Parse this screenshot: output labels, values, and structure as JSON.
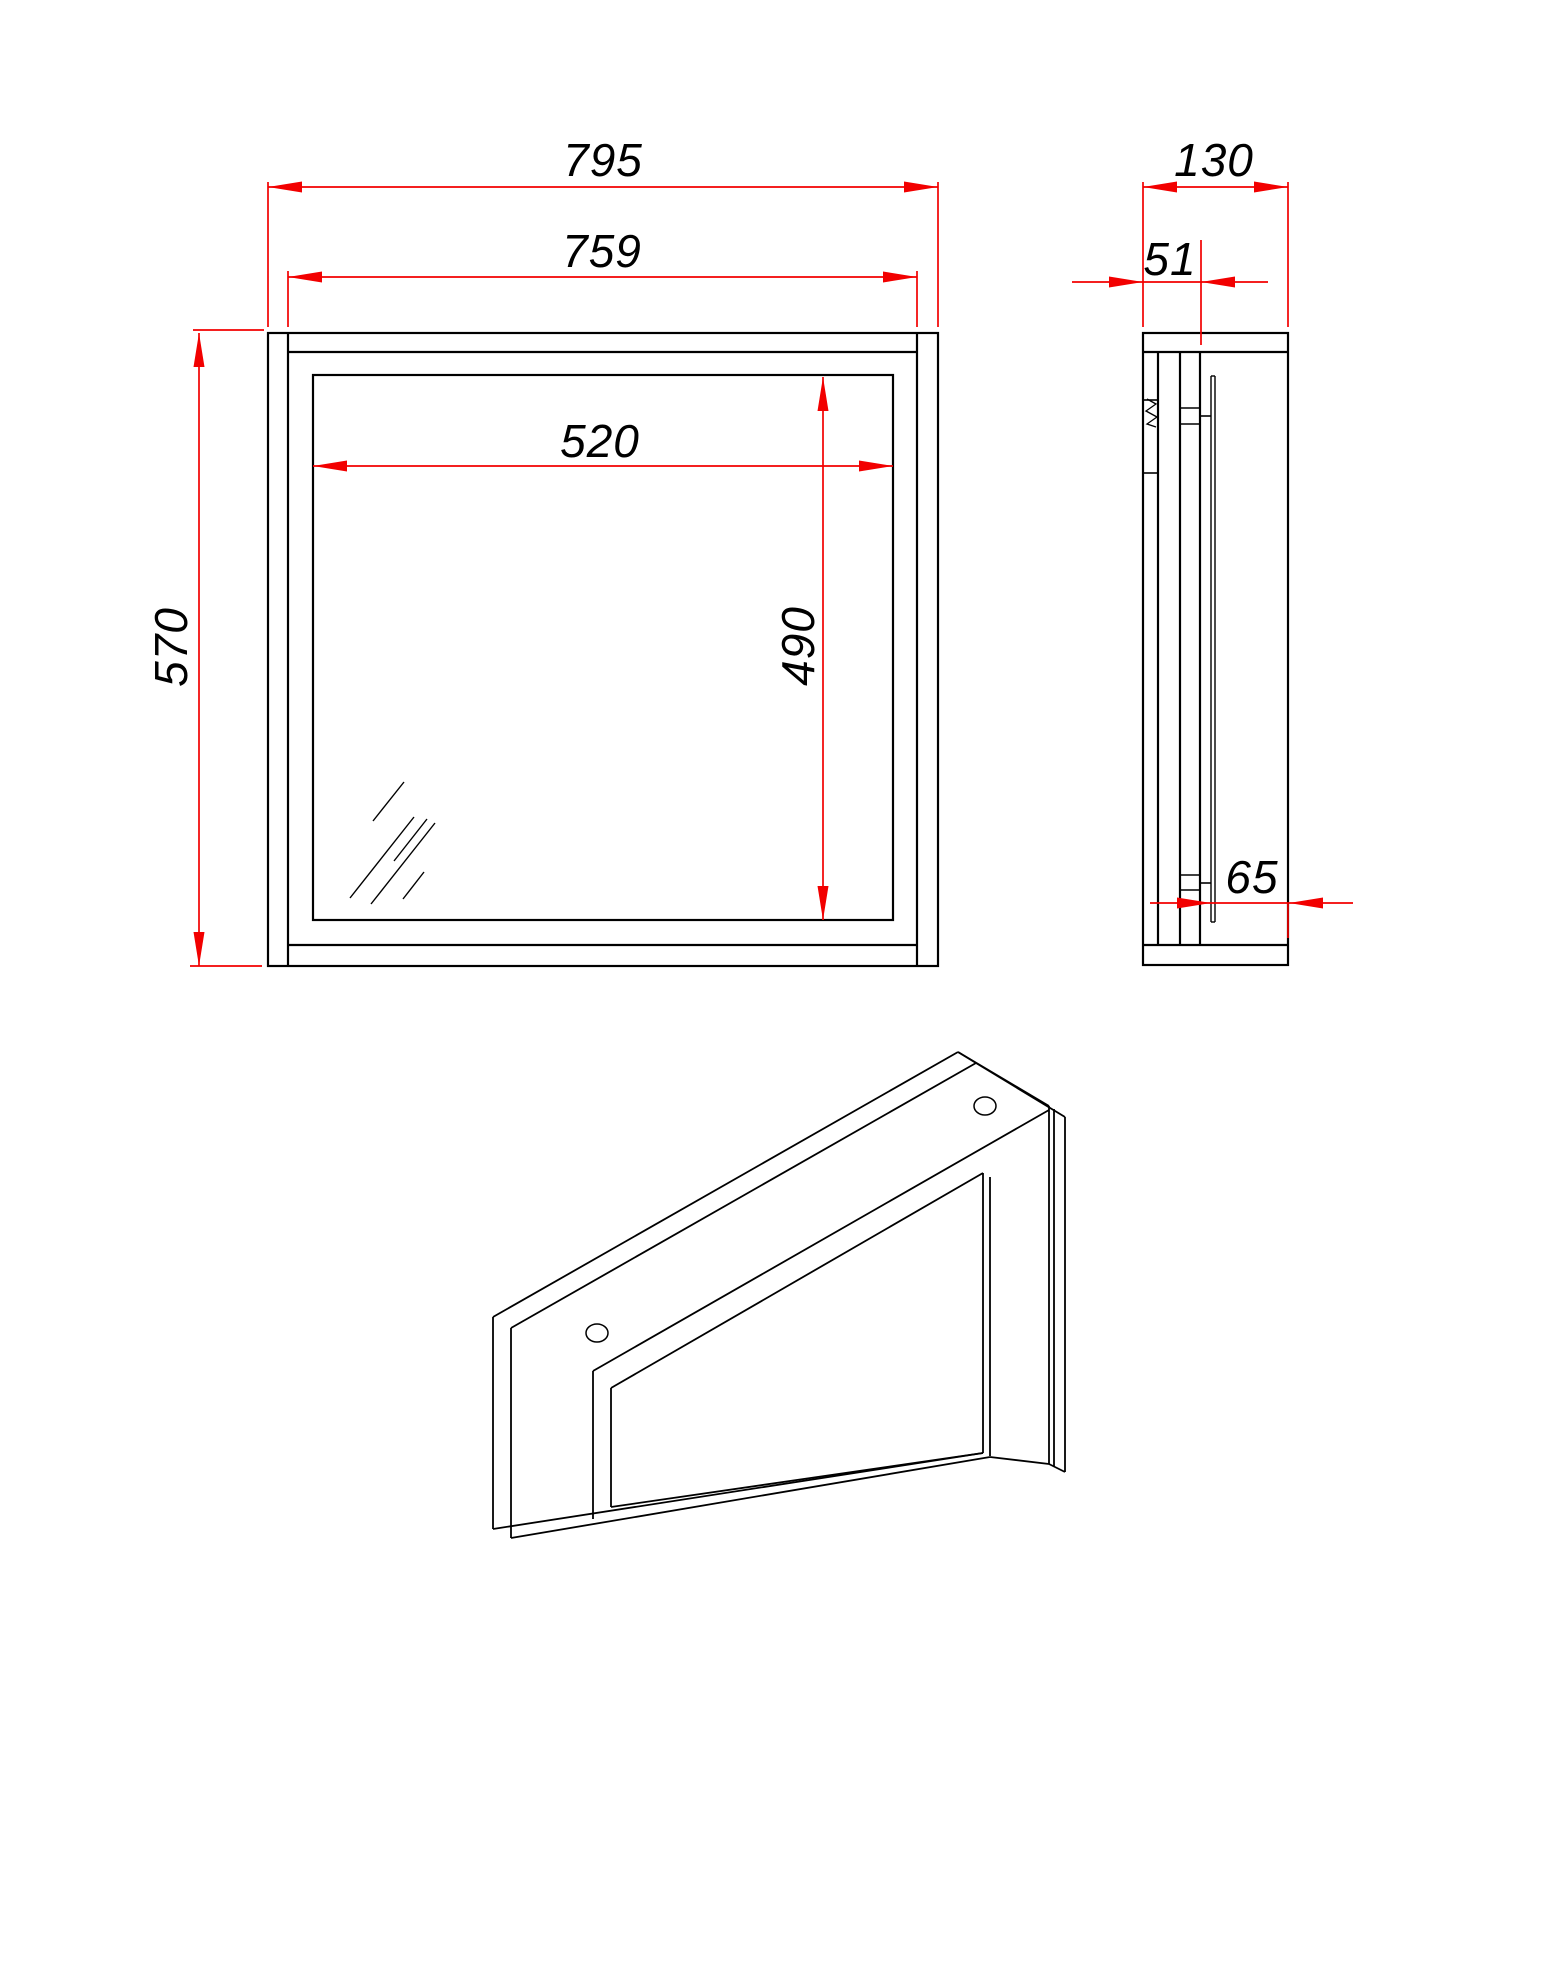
{
  "page": {
    "background": "#ffffff"
  },
  "drawing": {
    "type": "technical-drawing",
    "subject": "wall mirror cabinet frame - front view, side section view and perspective view",
    "line_color": "#000000",
    "dimension_color": "#f20000",
    "dimensions": {
      "front_outer_width": {
        "value": "795"
      },
      "front_inner_width": {
        "value": "759"
      },
      "front_height": {
        "value": "570"
      },
      "mirror_opening_width": {
        "value": "520"
      },
      "mirror_opening_height": {
        "value": "490"
      },
      "side_depth": {
        "value": "130"
      },
      "side_back_offset": {
        "value": "51"
      },
      "side_front_recess": {
        "value": "65"
      }
    }
  }
}
